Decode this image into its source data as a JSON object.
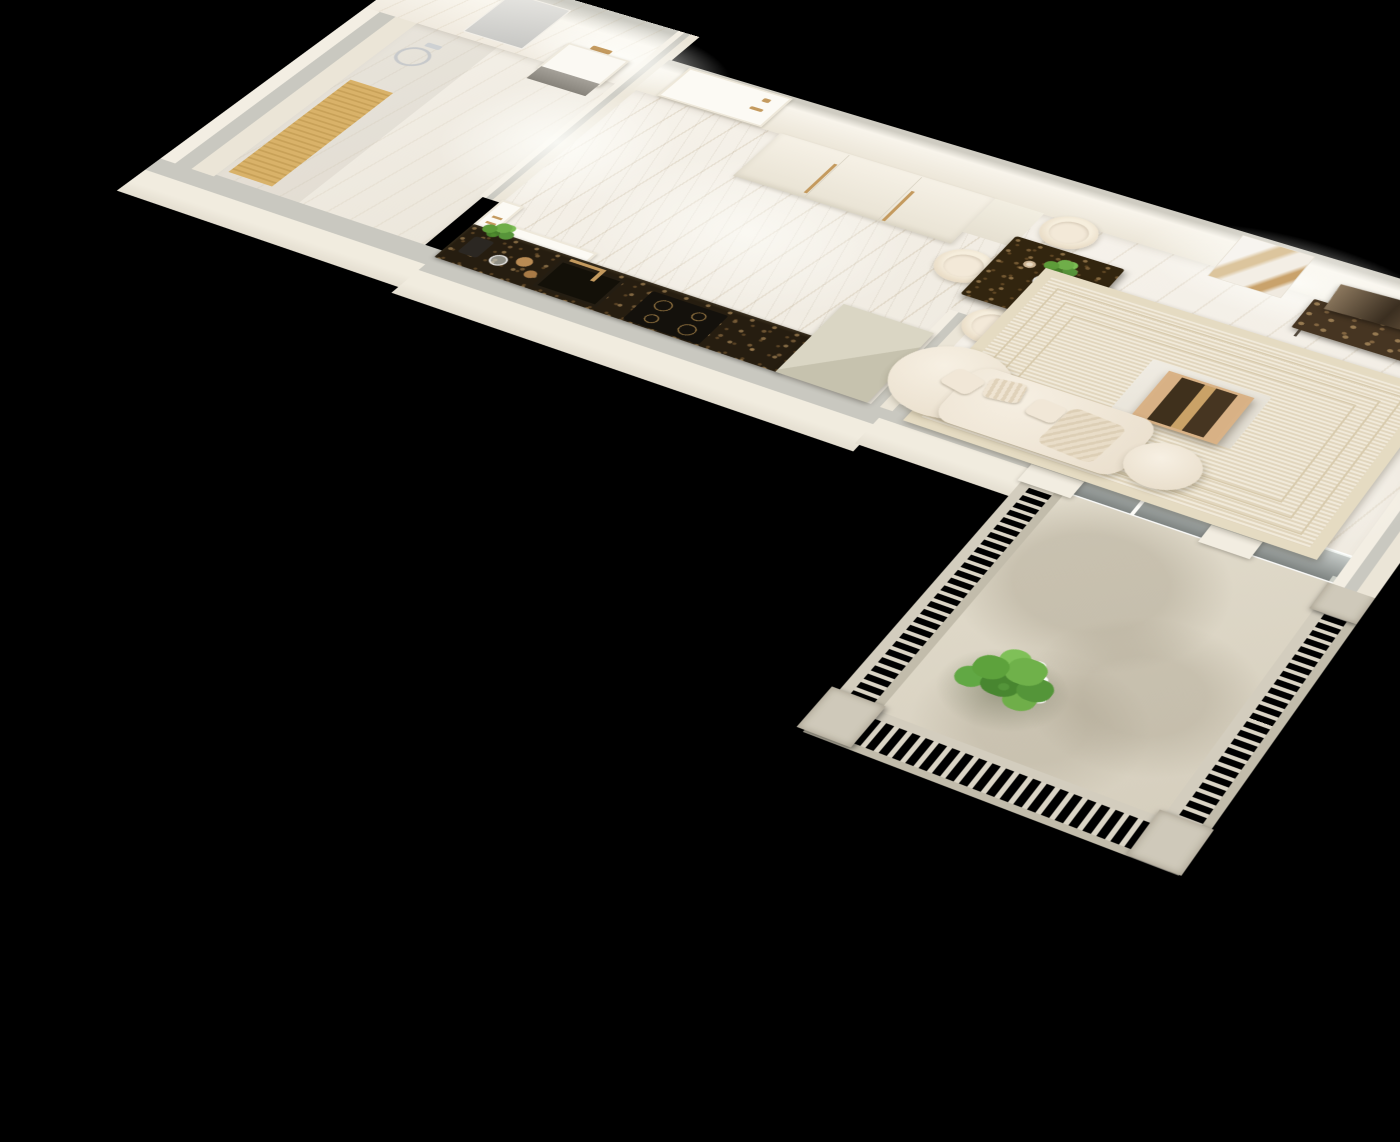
{
  "meta": {
    "subject": "Photorealistic 3D cutaway floor-plan render of a studio apartment seen from above on a black background",
    "view": "top-down axonometric with perspective",
    "background": "#000000"
  },
  "palette": {
    "background": "#000000",
    "wall_face": "#f2ede2",
    "wall_top": "#c9c8c0",
    "marble_floor": "#f3efe7",
    "marble_vein": "#b7a27d",
    "dark_emperador_marble": "#2e2414",
    "brass": "#c49a5e",
    "upholstery_cream": "#f0e7d7",
    "timber": "#d9ba8c",
    "rug": "#ebe1cb",
    "balustrade_stone": "#d2ccbd",
    "foliage": "#5da23c",
    "flowers": "#ffffff",
    "glazing": "#dfe7e4"
  },
  "rooms": {
    "bathroom": {
      "label": "Bathroom - marble walls, wall-hung washbasin with brass tap, mirror, chrome hand shower and timber bath mat"
    },
    "hallway": {
      "label": "Entrance hall - front door, full-height wardrobe with long brass pulls, veined marble floor"
    },
    "kitchen": {
      "label": "Kitchen run - dark emperador marble worktop with black sink, brass mixer, induction hob, herb pot and beige tall unit"
    },
    "living_room": {
      "label": "Living and dining room - square marble dining table with four cream chairs, wall art, TV on marble media unit, striped rug, brass coffee table, curved cream sofa"
    },
    "balcony": {
      "label": "Balcony - stone balustrade with turned balusters, glazed sliding doors and planter of white star flowers"
    }
  },
  "items": {
    "mirror": {
      "label": "Bathroom mirror"
    },
    "basin": {
      "label": "Wall-hung washbasin with brass tap and grey towel"
    },
    "shower": {
      "label": "Chrome hand shower on wall rail"
    },
    "bath_mat": {
      "label": "Timber slatted bath mat"
    },
    "bathroom_door": {
      "label": "Bathroom door with brass handles"
    },
    "laundry_cabinet": {
      "label": "Low white cabinet beside bathroom door"
    },
    "front_door": {
      "label": "Front entry door with brass lever handle and peephole"
    },
    "wardrobe": {
      "label": "Built-in three-door wardrobe with long brass pulls"
    },
    "bench": {
      "label": "Low hallway storage unit"
    },
    "counter": {
      "label": "Dark emperador marble kitchen worktop"
    },
    "kitchen_plant": {
      "label": "Potted herb plant and glassware on the worktop"
    },
    "kitchen_sink": {
      "label": "Black undermount sink with brass mixer tap"
    },
    "hob": {
      "label": "Black induction hob with four brass-ringed zones"
    },
    "tall_unit": {
      "label": "Beige tall kitchen unit"
    },
    "dining_table": {
      "label": "Square dark marble dining table"
    },
    "dining_chair": {
      "label": "Cream upholstered dining chair with timber legs"
    },
    "vase": {
      "label": "Glass vase with a green branch and two small cups"
    },
    "wall_art": {
      "label": "Gold and white abstract artwork on the wall"
    },
    "tv_console": {
      "label": "Dark marble media console on hairpin legs"
    },
    "tv": {
      "label": "Flat-screen television"
    },
    "rug": {
      "label": "Cream rug with fine concentric striped border"
    },
    "rug_mat": {
      "label": "White marble mat under the coffee table"
    },
    "coffee_table": {
      "label": "Brass-framed cube coffee table with marble bands"
    },
    "sofa": {
      "label": "Curved cream boucle sofa with cushions and throw pillows"
    },
    "ottoman": {
      "label": "Round cream swivel ottoman"
    },
    "balcony_floor": {
      "label": "Stone balcony deck"
    },
    "railing": {
      "label": "Stone balustrade with vertical balusters"
    },
    "glazing": {
      "label": "Sliding glass doors between living room and balcony"
    },
    "balcony_plant": {
      "label": "Planter with grasses and white star flowers"
    }
  }
}
